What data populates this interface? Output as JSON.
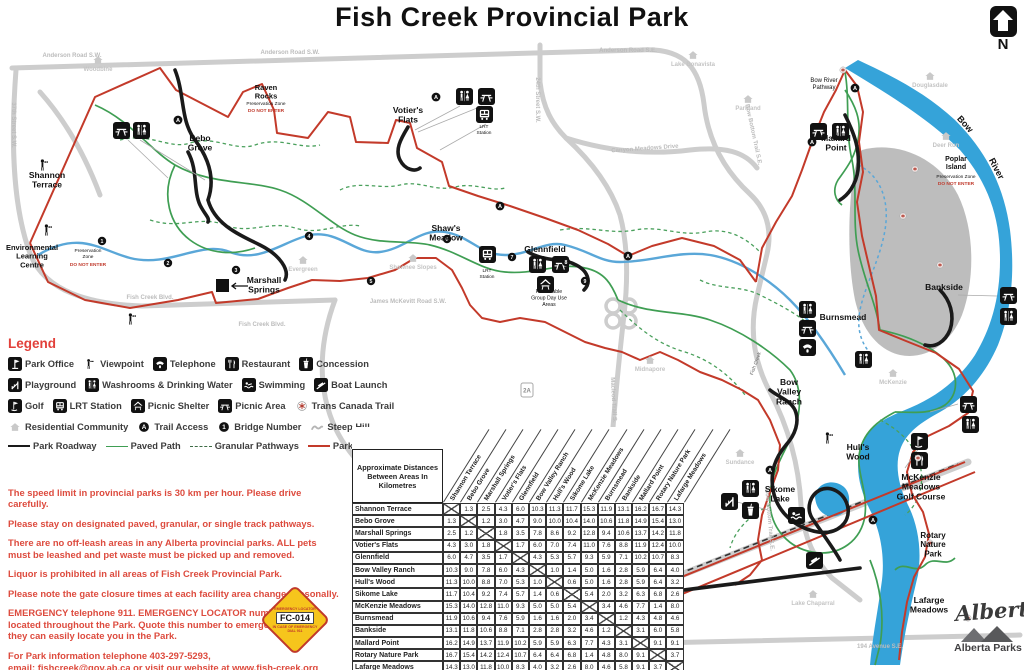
{
  "header": {
    "title": "Fish Creek Provincial Park",
    "north_label": "N"
  },
  "colors": {
    "boundary_red": "#c33a2a",
    "path_green": "#3f9e53",
    "water_blue": "#35a3d9",
    "road_gray": "#cdcdcd",
    "island_gray": "#bdbdbd",
    "note_red": "#dd4b3e",
    "legend_red": "#e2403a",
    "roadway_black": "#1a1a1a",
    "sign_yellow": "#f6c51c"
  },
  "legend": {
    "title": "Legend",
    "rows": [
      [
        {
          "icon": "office",
          "label": "Park Office"
        },
        {
          "icon": "viewpoint",
          "label": "Viewpoint"
        },
        {
          "icon": "telephone",
          "label": "Telephone"
        },
        {
          "icon": "restaurant",
          "label": "Restaurant"
        },
        {
          "icon": "concession",
          "label": "Concession"
        }
      ],
      [
        {
          "icon": "playground",
          "label": "Playground"
        },
        {
          "icon": "washrooms",
          "label": "Washrooms & Drinking Water"
        },
        {
          "icon": "swimming",
          "label": "Swimming"
        },
        {
          "icon": "boatlaunch",
          "label": "Boat Launch"
        }
      ],
      [
        {
          "icon": "golf",
          "label": "Golf"
        },
        {
          "icon": "lrt",
          "label": "LRT Station"
        },
        {
          "icon": "shelter",
          "label": "Picnic Shelter"
        },
        {
          "icon": "picnic",
          "label": "Picnic Area"
        },
        {
          "icon": "tct",
          "label": "Trans Canada Trail"
        }
      ],
      [
        {
          "icon": "residential",
          "label": "Residential Community"
        },
        {
          "icon": "trailaccess",
          "label": "Trail Access"
        },
        {
          "icon": "bridge",
          "label": "Bridge Number"
        },
        {
          "icon": "steephill",
          "label": "Steep Hill"
        }
      ]
    ],
    "lines": [
      {
        "kind": "roadway",
        "label": "Park Roadway"
      },
      {
        "kind": "paved",
        "label": "Paved Path"
      },
      {
        "kind": "granular",
        "label": "Granular Pathways"
      },
      {
        "kind": "boundary",
        "label": "Park Boundary"
      }
    ]
  },
  "notes": [
    {
      "text": "The speed limit in provincial parks is 30 km per hour. Please drive carefully."
    },
    {
      "text": "Please stay on designated paved, granular, or single track pathways."
    },
    {
      "text": "There are no off-leash areas in any Alberta provincial parks. ALL pets must be leashed and pet waste must be picked up and removed."
    },
    {
      "text": "Liquor is prohibited in all areas of Fish Creek Provincial Park."
    },
    {
      "text": "Please note the gate closure times at each facility area change seasonally."
    },
    {
      "text": "EMERGENCY telephone 911. EMERGENCY LOCATOR numbers are located throughout the Park. Quote this number to emergency staff so they can easily locate you in the Park."
    },
    {
      "text": "For Park information telephone 403-297-5293,"
    },
    {
      "text": "email: fishcreek@gov.ab.ca or visit our website at www.fish-creek.org",
      "tight": true
    }
  ],
  "emergency_sign": {
    "top": "EMERGENCY LOCATOR",
    "code": "FC-014",
    "bottom": "IN CASE OF EMERGENCY",
    "dial": "DIAL 911"
  },
  "distance_table": {
    "title": "Approximate Distances Between Areas In Kilometres",
    "areas": [
      "Shannon Terrace",
      "Bebo Grove",
      "Marshall Springs",
      "Votier's Flats",
      "Glennfield",
      "Bow Valley Ranch",
      "Hull's Wood",
      "Sikome Lake",
      "McKenzie Meadows",
      "Burnsmead",
      "Bankside",
      "Mallard Point",
      "Rotary Nature Park",
      "Lafarge Meadows"
    ],
    "matrix": [
      [
        "X",
        "1.3",
        "2.5",
        "4.3",
        "6.0",
        "10.3",
        "11.3",
        "11.7",
        "15.3",
        "11.9",
        "13.1",
        "16.2",
        "16.7",
        "14.3"
      ],
      [
        "1.3",
        "X",
        "1.2",
        "3.0",
        "4.7",
        "9.0",
        "10.0",
        "10.4",
        "14.0",
        "10.6",
        "11.8",
        "14.9",
        "15.4",
        "13.0"
      ],
      [
        "2.5",
        "1.2",
        "X",
        "1.8",
        "3.5",
        "7.8",
        "8.6",
        "9.2",
        "12.8",
        "9.4",
        "10.6",
        "13.7",
        "14.2",
        "11.8"
      ],
      [
        "4.3",
        "3.0",
        "1.8",
        "X",
        "1.7",
        "6.0",
        "7.0",
        "7.4",
        "11.0",
        "7.6",
        "8.8",
        "11.9",
        "12.4",
        "10.0"
      ],
      [
        "6.0",
        "4.7",
        "3.5",
        "1.7",
        "X",
        "4.3",
        "5.3",
        "5.7",
        "9.3",
        "5.9",
        "7.1",
        "10.2",
        "10.7",
        "8.3"
      ],
      [
        "10.3",
        "9.0",
        "7.8",
        "6.0",
        "4.3",
        "X",
        "1.0",
        "1.4",
        "5.0",
        "1.6",
        "2.8",
        "5.9",
        "6.4",
        "4.0"
      ],
      [
        "11.3",
        "10.0",
        "8.8",
        "7.0",
        "5.3",
        "1.0",
        "X",
        "0.6",
        "5.0",
        "1.6",
        "2.8",
        "5.9",
        "6.4",
        "3.2"
      ],
      [
        "11.7",
        "10.4",
        "9.2",
        "7.4",
        "5.7",
        "1.4",
        "0.6",
        "X",
        "5.4",
        "2.0",
        "3.2",
        "6.3",
        "6.8",
        "2.6"
      ],
      [
        "15.3",
        "14.0",
        "12.8",
        "11.0",
        "9.3",
        "5.0",
        "5.0",
        "5.4",
        "X",
        "3.4",
        "4.6",
        "7.7",
        "1.4",
        "8.0"
      ],
      [
        "11.9",
        "10.6",
        "9.4",
        "7.6",
        "5.9",
        "1.6",
        "1.6",
        "2.0",
        "3.4",
        "X",
        "1.2",
        "4.3",
        "4.8",
        "4.6"
      ],
      [
        "13.1",
        "11.8",
        "10.6",
        "8.8",
        "7.1",
        "2.8",
        "2.8",
        "3.2",
        "4.6",
        "1.2",
        "X",
        "3.1",
        "6.0",
        "5.8"
      ],
      [
        "16.2",
        "14.9",
        "13.7",
        "11.9",
        "10.2",
        "5.9",
        "5.9",
        "6.3",
        "7.7",
        "4.3",
        "3.1",
        "X",
        "9.1",
        "9.1"
      ],
      [
        "16.7",
        "15.4",
        "14.2",
        "12.4",
        "10.7",
        "6.4",
        "6.4",
        "6.8",
        "1.4",
        "4.8",
        "8.0",
        "9.1",
        "X",
        "3.7"
      ],
      [
        "14.3",
        "13.0",
        "11.8",
        "10.0",
        "8.3",
        "4.0",
        "3.2",
        "2.6",
        "8.0",
        "4.6",
        "5.8",
        "9.1",
        "3.7",
        "X"
      ]
    ]
  },
  "map": {
    "area_labels": [
      {
        "t": "Shannon|Terrace",
        "x": 47,
        "y": 178
      },
      {
        "t": "Bebo|Grove",
        "x": 200,
        "y": 141
      },
      {
        "t": "Environmental|Learning|Centre",
        "x": 32,
        "y": 250,
        "s": 7.5
      },
      {
        "t": "Preservation|Zone",
        "x": 88,
        "y": 252,
        "s": 4.8,
        "w": 400
      },
      {
        "t": "DO NOT ENTER",
        "x": 88,
        "y": 266,
        "s": 4.8,
        "c": "#c0392b"
      },
      {
        "t": "Raven|Rocks",
        "x": 266,
        "y": 90,
        "s": 7.5
      },
      {
        "t": "Preservation Zone",
        "x": 266,
        "y": 105,
        "s": 4.8,
        "w": 400
      },
      {
        "t": "DO NOT ENTER",
        "x": 266,
        "y": 112,
        "s": 4.8,
        "c": "#c0392b"
      },
      {
        "t": "Marshall|Springs",
        "x": 264,
        "y": 283
      },
      {
        "t": "Votier's|Flats",
        "x": 408,
        "y": 113
      },
      {
        "t": "Shaw's|Meadow",
        "x": 446,
        "y": 231
      },
      {
        "t": "Glennfield",
        "x": 545,
        "y": 252
      },
      {
        "t": "Reservable|Group Day Use|Areas",
        "x": 549,
        "y": 293,
        "s": 5.2,
        "w": 400
      },
      {
        "t": "Bow|Valley|Ranch",
        "x": 789,
        "y": 385
      },
      {
        "t": "Hull's|Wood",
        "x": 858,
        "y": 450
      },
      {
        "t": "Sikome|Lake",
        "x": 780,
        "y": 492
      },
      {
        "t": "McKenzie|Meadows|Golf Course",
        "x": 921,
        "y": 480
      },
      {
        "t": "Rotary|Nature|Park",
        "x": 933,
        "y": 538,
        "s": 8
      },
      {
        "t": "Lafarge|Meadows",
        "x": 929,
        "y": 603
      },
      {
        "t": "Burnsmead",
        "x": 843,
        "y": 320
      },
      {
        "t": "Bankside",
        "x": 944,
        "y": 290
      },
      {
        "t": "Mallard|Point",
        "x": 836,
        "y": 141
      },
      {
        "t": "Bow River|Pathway",
        "x": 824,
        "y": 82,
        "s": 6,
        "w": 400
      },
      {
        "t": "Poplar|Island",
        "x": 956,
        "y": 161,
        "s": 7
      },
      {
        "t": "Preservation Zone",
        "x": 956,
        "y": 178,
        "s": 4.8,
        "w": 400
      },
      {
        "t": "DO NOT ENTER",
        "x": 956,
        "y": 185,
        "s": 4.8,
        "c": "#c0392b"
      },
      {
        "t": "Bow",
        "x": 963,
        "y": 126,
        "r": 48,
        "s": 9
      },
      {
        "t": "River",
        "x": 994,
        "y": 170,
        "r": 62,
        "s": 9
      },
      {
        "t": "Fish Creek",
        "x": 757,
        "y": 364,
        "r": -70,
        "s": 5,
        "w": 400,
        "c": "#666"
      },
      {
        "t": "LRT|Station",
        "x": 484,
        "y": 128,
        "s": 4.8,
        "w": 400
      },
      {
        "t": "LRT|Station",
        "x": 487,
        "y": 272,
        "s": 4.8,
        "w": 400
      }
    ],
    "road_labels": [
      {
        "t": "Anderson Road S.W.",
        "x": 72,
        "y": 57
      },
      {
        "t": "Anderson Road S.W.",
        "x": 290,
        "y": 54
      },
      {
        "t": "Anderson Road S.E.",
        "x": 628,
        "y": 52
      },
      {
        "t": "24th Street S.W.",
        "x": 536,
        "y": 100,
        "r": 90
      },
      {
        "t": "37th Street S.W.",
        "x": 12,
        "y": 125,
        "r": 90
      },
      {
        "t": "Fish Creek Blvd.",
        "x": 150,
        "y": 299
      },
      {
        "t": "Fish Creek Blvd.",
        "x": 262,
        "y": 326
      },
      {
        "t": "James McKevitt Road S.W.",
        "x": 408,
        "y": 303
      },
      {
        "t": "Canyon Meadows Drive",
        "x": 645,
        "y": 150,
        "r": -4
      },
      {
        "t": "Bow Bottom Trail S.E.",
        "x": 752,
        "y": 135,
        "r": 78
      },
      {
        "t": "Bow Bottom Trail S.E.",
        "x": 768,
        "y": 520,
        "r": 85
      },
      {
        "t": "Macleod Trail S.",
        "x": 612,
        "y": 400,
        "r": 87
      },
      {
        "t": "194 Avenue S.E.",
        "x": 880,
        "y": 648
      }
    ],
    "communities": [
      {
        "name": "Woodbine",
        "x": 98,
        "y": 62
      },
      {
        "name": "Evergreen",
        "x": 303,
        "y": 262
      },
      {
        "name": "Shawnee Slopes",
        "x": 413,
        "y": 260
      },
      {
        "name": "Lake Bonavista",
        "x": 693,
        "y": 57
      },
      {
        "name": "Parkland",
        "x": 748,
        "y": 101
      },
      {
        "name": "Douglasdale",
        "x": 930,
        "y": 78
      },
      {
        "name": "Deer Run",
        "x": 946,
        "y": 138
      },
      {
        "name": "McKenzie",
        "x": 893,
        "y": 375
      },
      {
        "name": "Midnapore",
        "x": 650,
        "y": 362
      },
      {
        "name": "Sundance",
        "x": 740,
        "y": 455
      },
      {
        "name": "Lake Chaparral",
        "x": 813,
        "y": 596
      }
    ],
    "facility_icons": [
      {
        "type": "picnic",
        "x": 113,
        "y": 122
      },
      {
        "type": "washrooms",
        "x": 133,
        "y": 122
      },
      {
        "type": "washrooms",
        "x": 456,
        "y": 88
      },
      {
        "type": "picnic",
        "x": 478,
        "y": 88
      },
      {
        "type": "lrt",
        "x": 476,
        "y": 106
      },
      {
        "type": "lrt",
        "x": 479,
        "y": 246
      },
      {
        "type": "washrooms",
        "x": 529,
        "y": 256
      },
      {
        "type": "picnic",
        "x": 552,
        "y": 256
      },
      {
        "type": "shelter",
        "x": 537,
        "y": 276
      },
      {
        "type": "picnic",
        "x": 810,
        "y": 123
      },
      {
        "type": "washrooms",
        "x": 832,
        "y": 123
      },
      {
        "type": "washrooms",
        "x": 799,
        "y": 301
      },
      {
        "type": "picnic",
        "x": 799,
        "y": 320
      },
      {
        "type": "telephone",
        "x": 799,
        "y": 339
      },
      {
        "type": "washrooms",
        "x": 855,
        "y": 351
      },
      {
        "type": "picnic",
        "x": 1000,
        "y": 287
      },
      {
        "type": "washrooms",
        "x": 1000,
        "y": 308
      },
      {
        "type": "picnic",
        "x": 960,
        "y": 396
      },
      {
        "type": "washrooms",
        "x": 962,
        "y": 416
      },
      {
        "type": "golf",
        "x": 911,
        "y": 433
      },
      {
        "type": "restaurant",
        "x": 911,
        "y": 452
      },
      {
        "type": "playground",
        "x": 721,
        "y": 493
      },
      {
        "type": "washrooms",
        "x": 742,
        "y": 480
      },
      {
        "type": "concession",
        "x": 742,
        "y": 502
      },
      {
        "type": "swimming",
        "x": 788,
        "y": 507
      },
      {
        "type": "boatlaunch",
        "x": 806,
        "y": 552
      }
    ],
    "viewpoints": [
      {
        "x": 36,
        "y": 157
      },
      {
        "x": 40,
        "y": 222
      },
      {
        "x": 124,
        "y": 311
      },
      {
        "x": 821,
        "y": 430
      }
    ],
    "bridges": [
      {
        "n": "1",
        "x": 102,
        "y": 241
      },
      {
        "n": "2",
        "x": 168,
        "y": 263
      },
      {
        "n": "3",
        "x": 236,
        "y": 270
      },
      {
        "n": "4",
        "x": 309,
        "y": 236
      },
      {
        "n": "5",
        "x": 371,
        "y": 281
      },
      {
        "n": "6",
        "x": 447,
        "y": 239
      },
      {
        "n": "7",
        "x": 512,
        "y": 257
      },
      {
        "n": "8",
        "x": 566,
        "y": 262
      },
      {
        "n": "9",
        "x": 585,
        "y": 281
      }
    ],
    "trail_access": [
      {
        "x": 178,
        "y": 120
      },
      {
        "x": 436,
        "y": 97
      },
      {
        "x": 500,
        "y": 206
      },
      {
        "x": 855,
        "y": 88
      },
      {
        "x": 812,
        "y": 142
      },
      {
        "x": 770,
        "y": 470
      },
      {
        "x": 873,
        "y": 520
      },
      {
        "x": 628,
        "y": 256
      }
    ],
    "tct_markers": [
      {
        "x": 843,
        "y": 70
      },
      {
        "x": 915,
        "y": 169
      },
      {
        "x": 903,
        "y": 216
      },
      {
        "x": 940,
        "y": 265
      },
      {
        "x": 918,
        "y": 458
      },
      {
        "x": 930,
        "y": 543
      },
      {
        "x": 968,
        "y": 618
      }
    ],
    "highway_shields": [
      {
        "t": "2A",
        "x": 527,
        "y": 390
      }
    ]
  },
  "branding": {
    "alberta_script": "Alberta",
    "alberta_parks": "Alberta Parks"
  }
}
